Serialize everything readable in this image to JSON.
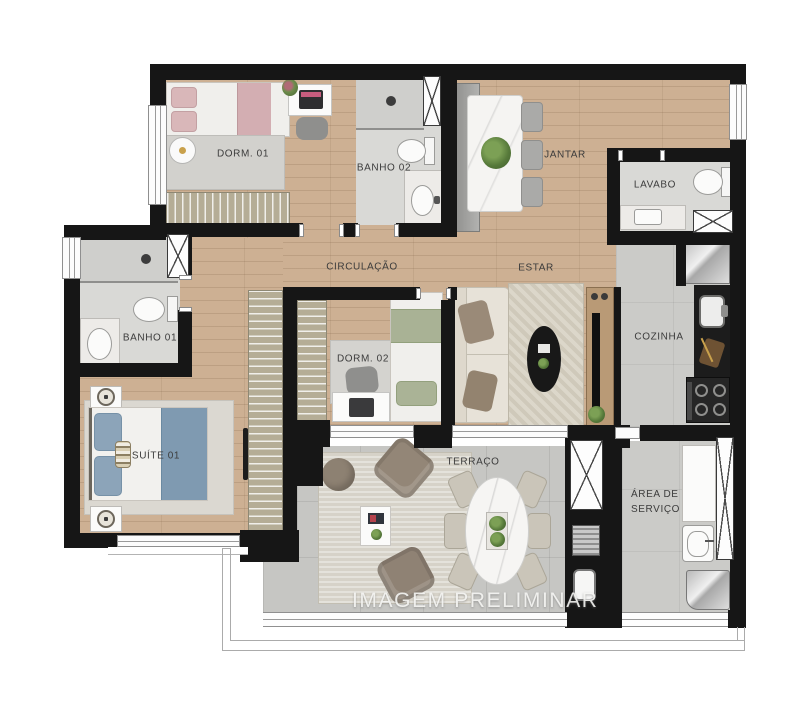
{
  "rooms": {
    "dorm01": "DORM. 01",
    "banho02": "BANHO 02",
    "jantar": "JANTAR",
    "lavabo": "LAVABO",
    "circulacao": "CIRCULAÇÃO",
    "estar": "ESTAR",
    "banho01": "BANHO 01",
    "dorm02": "DORM. 02",
    "cozinha": "COZINHA",
    "suite01": "SUÍTE 01",
    "terraco": "TERRAÇO",
    "area_servico": "ÁREA DE SERVIÇO"
  },
  "watermark": "IMAGEM PRELIMINAR",
  "colors": {
    "wall": "#161616",
    "wood_floor": "#cdb093",
    "bath_tile": "#d9d9d6",
    "terrace_tile": "#c6c6c3",
    "accent_pink": "#d9b7b9",
    "accent_blue": "#8ca4b9",
    "accent_green": "#a9b295",
    "label_text": "#3c3c3c",
    "watermark_text": "#f8f8f6"
  }
}
